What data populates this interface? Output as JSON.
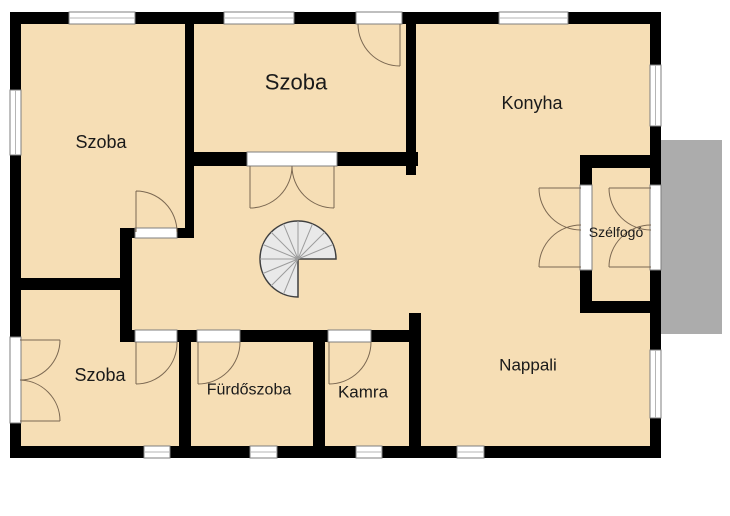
{
  "plan": {
    "labels": {
      "szoba_top_left": "Szoba",
      "szoba_middle": "Szoba",
      "konyha": "Konyha",
      "szelfogo": "Szélfogó",
      "nappali": "Nappali",
      "szoba_bottom": "Szoba",
      "furdoszoba": "Fürdőszoba",
      "kamra": "Kamra"
    },
    "colors": {
      "background": "#ffffff",
      "floor": "#f6deb5",
      "wall": "#000000",
      "patio": "#acacac",
      "window_fill": "#ffffff",
      "window_frame": "#7f7f7f",
      "window_line": "#b5b5b5",
      "door_arc": "#7b6852",
      "stair_fill": "#e9e9e9",
      "stair_stroke": "#3f3f3f",
      "stair_tread": "#9c9c9c",
      "label": "#1a1a1a"
    }
  }
}
